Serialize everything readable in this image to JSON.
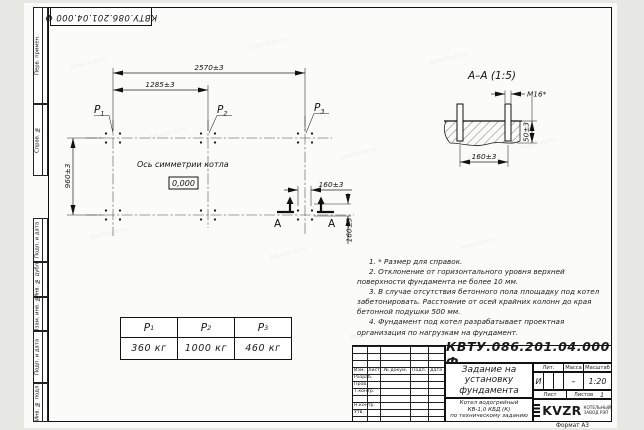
{
  "sheet": {
    "stamp_top": "КВТУ.086.201.04.000  Ф",
    "format_label": "Формат А3",
    "watermark": "kotel-kvzr.ru",
    "left_strip": {
      "perv_primen": "Перв. примен.",
      "sprav_no": "Справ. №",
      "podp_data_1": "Подп. и дата",
      "inv_dubl": "Инв. № дубл.",
      "vzam_inv": "Взам. инв. №",
      "podp_data_2": "Подп. и дата",
      "inv_podl": "Инв. № подл."
    }
  },
  "plan": {
    "dim_overall": "2570±3",
    "dim_half": "1285±3",
    "dim_depth": "960±3",
    "dim_bolt_x": "160±3",
    "dim_bolt_y": "160±3",
    "axis_label": "Ось симметрии котла",
    "level_mark": "0,000",
    "p1": "P",
    "p1_sub": "1",
    "p2": "P",
    "p2_sub": "2",
    "p3": "P",
    "p3_sub": "3",
    "section_mark_left": "А",
    "section_mark_right": "А"
  },
  "section": {
    "title": "А–А  (1:5)",
    "dim_thread": "М16*",
    "dim_height": "50±3",
    "dim_spacing": "160±3"
  },
  "notes": [
    "1. * Размер для справок.",
    "2. Отклонение от горизонтального уровня верхней поверхности фундамента не более 10 мм.",
    "3. В случае отсутствия бетонного пола площадку под котел забетонировать. Расстояние от осей крайних колонн до края бетонной подушки 500 мм.",
    "4. Фундамент под котел разрабатывает проектная организация по нагрузкам на фундамент."
  ],
  "load_table": {
    "h1": "P",
    "h1_sub": "1",
    "h2": "P",
    "h2_sub": "2",
    "h3": "P",
    "h3_sub": "3",
    "v1": "360 кг",
    "v2": "1000 кг",
    "v3": "460 кг"
  },
  "title_block": {
    "designation": "КВТУ.086.201.04.000  Ф",
    "doc_title": "Задание на установку фундамента",
    "product_line1": "Котел водогрейный",
    "product_line2": "КВ-1,0 КБД (К)",
    "product_line3": "по техническому заданию",
    "col_izm": "Изм.",
    "col_list": "Лист",
    "col_doc": "№ докум.",
    "col_sign": "Подп.",
    "col_date": "Дата",
    "row_razrab": "Разраб.",
    "row_prov": "Пров.",
    "row_tkontr": "Т.контр.",
    "row_nkontr": "Н.контр.",
    "row_utv": "Утв.",
    "lit_label": "Лит.",
    "lit_value": "И",
    "mass_label": "Масса",
    "mass_value": "–",
    "scale_label": "Масштаб",
    "scale_value": "1:20",
    "sheet_label": "Лист",
    "sheets_label": "Листов",
    "sheets_value": "1",
    "brand": "KVZR",
    "brand_line1": "КОТЕЛЬНЫЙ",
    "brand_line2": "ЗАВОД РЭП"
  }
}
